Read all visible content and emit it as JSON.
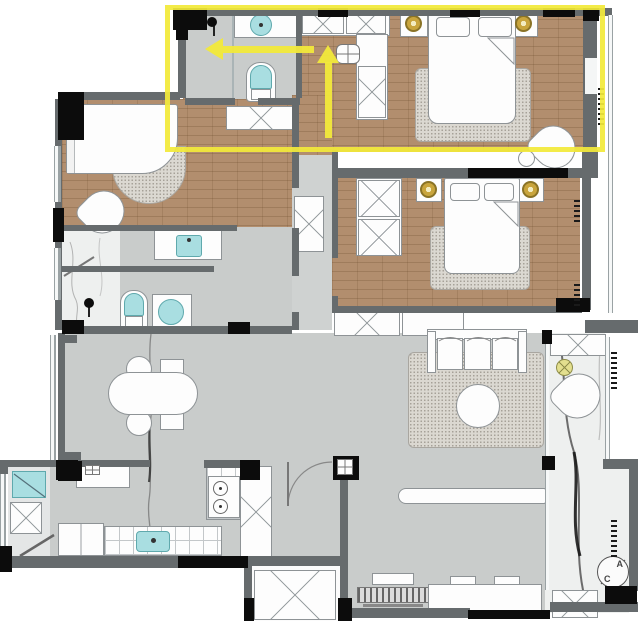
{
  "title": "apartment-floor-plan",
  "colors": {
    "background": "#ffffff",
    "wall_gray": "#666b6d",
    "wall_black": "#0c0c0c",
    "wood_floor": "#b28e6e",
    "gray_floor": "#c9cccb",
    "marble_floor": "#eef0ef",
    "rug": "#dbd8d1",
    "fixture_cyan": "#a9dee1",
    "furniture_white": "#fdfdfd",
    "furniture_border": "#8e9396",
    "lamp_gold": "#c9a53d",
    "highlight_yellow": "#f2e93a",
    "plant_yellow": "#e3df8e"
  },
  "annotations": {
    "highlight_box": {
      "x": 165,
      "y": 5,
      "width": 440,
      "height": 147
    },
    "arrows": [
      {
        "name": "arrow-left",
        "direction": "left"
      },
      {
        "name": "arrow-up",
        "direction": "up"
      }
    ]
  },
  "compass": {
    "top_letter": "A",
    "bottom_letter": "C"
  },
  "rooms": [
    {
      "name": "master-bathroom"
    },
    {
      "name": "walk-in-closet"
    },
    {
      "name": "master-bedroom"
    },
    {
      "name": "bedroom-2"
    },
    {
      "name": "bedroom-3"
    },
    {
      "name": "bathroom-2"
    },
    {
      "name": "bathroom-3"
    },
    {
      "name": "hallway"
    },
    {
      "name": "dining-area"
    },
    {
      "name": "kitchen"
    },
    {
      "name": "living-room"
    },
    {
      "name": "balcony"
    },
    {
      "name": "utility-balcony"
    },
    {
      "name": "storage-room"
    }
  ]
}
